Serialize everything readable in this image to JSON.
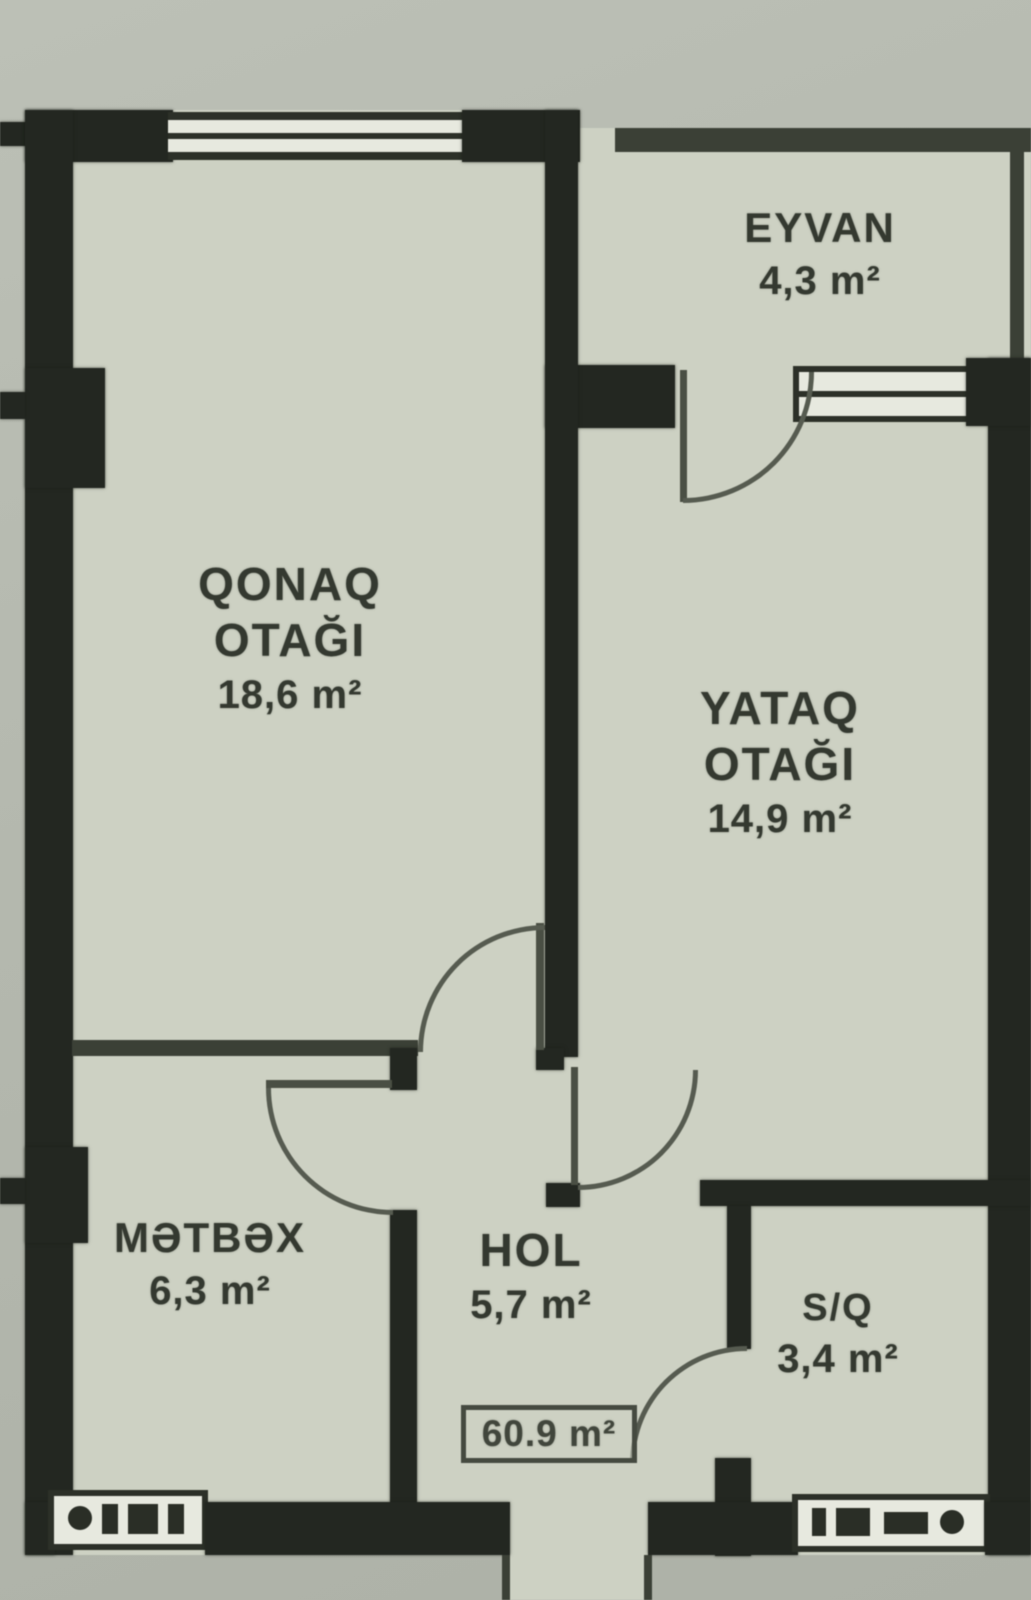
{
  "document": {
    "kind": "apartment-floor-plan-scan"
  },
  "rooms": {
    "eyvan": {
      "label": "EYVAN",
      "area": "4,3 m²"
    },
    "qonaq": {
      "label_line1": "QONAQ",
      "label_line2": "OTAĞI",
      "area": "18,6 m²"
    },
    "yataq": {
      "label_line1": "YATAQ",
      "label_line2": "OTAĞI",
      "area": "14,9 m²"
    },
    "metbex": {
      "label": "MƏTBƏX",
      "area": "6,3 m²"
    },
    "hol": {
      "label": "HOL",
      "area": "5,7 m²"
    },
    "sq": {
      "label": "S/Q",
      "area": "3,4 m²"
    }
  },
  "total": {
    "area_label": "60.9 m²"
  },
  "colors": {
    "wall": "#232721",
    "floor": "#cdd1c3",
    "background": "#b4b8ae",
    "line": "#3b4036",
    "text": "#343930"
  }
}
